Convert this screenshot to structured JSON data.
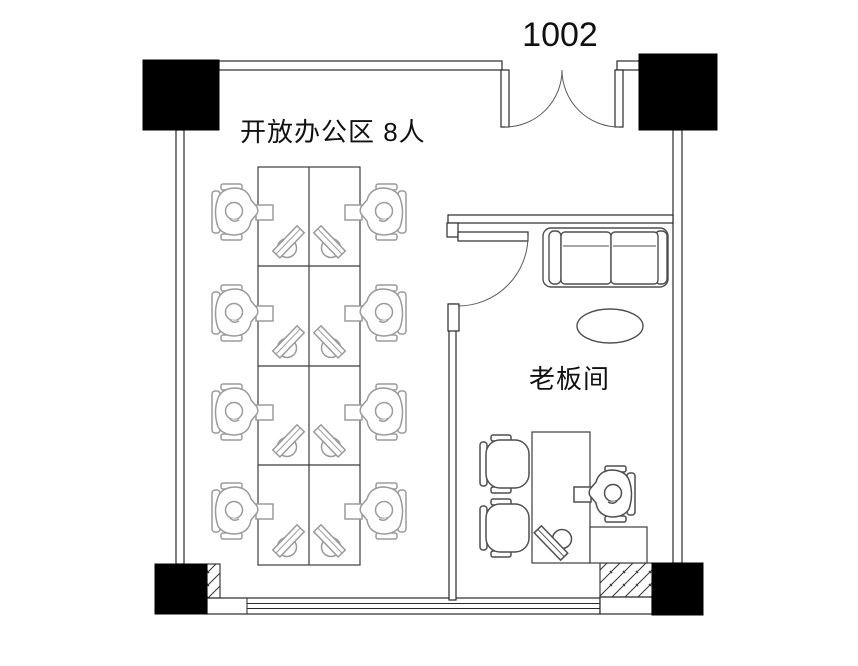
{
  "title": {
    "room_number": "1002"
  },
  "rooms": {
    "open_office": {
      "label": "开放办公区 8人",
      "workstation_count": 8
    },
    "boss_office": {
      "label": "老板间"
    }
  },
  "colors": {
    "background": "#ffffff",
    "wall": "#2a2a2a",
    "column": "#000000",
    "desk_outline": "#3c3c3c",
    "office_furniture": "#9b9b9b",
    "boss_furniture": "#4f4f4f"
  }
}
